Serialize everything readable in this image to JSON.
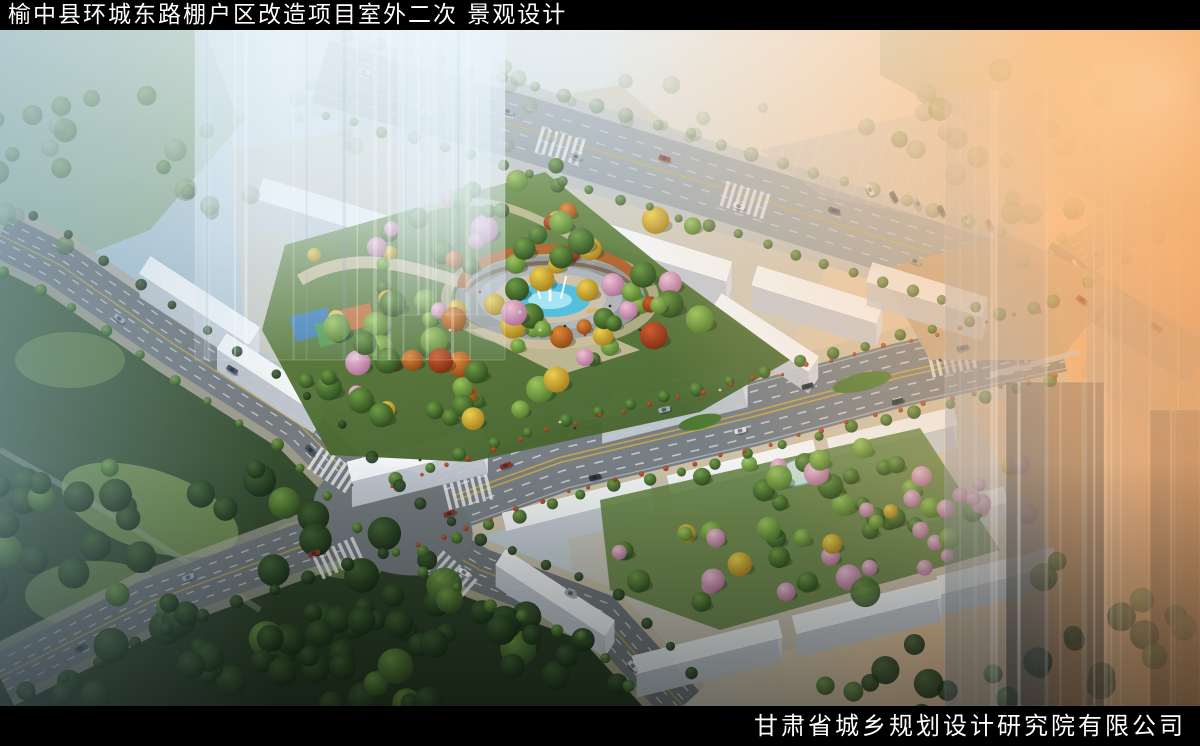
{
  "header": {
    "title": "榆中县环城东路棚户区改造项目室外二次 景观设计"
  },
  "footer": {
    "company": "甘肃省城乡规划设计研究院有限公司"
  },
  "palette": {
    "frame": "#000000",
    "title_text": "#ffffff",
    "haze_blue": "#9fbccd",
    "sun_glow": "#f7a85f",
    "asphalt": "#787f84",
    "lane_yellow": "#d9b23c",
    "sidewalk_tan": "#cdc1a4",
    "building_white": "#f4f7f9",
    "building_shade": "#c3cad2",
    "foliage_green": "#4a7a2e",
    "foliage_dark": "#2f4f28",
    "foliage_autumn": "#e0bc3a",
    "foliage_orange": "#d8802f",
    "foliage_pink": "#e2aec8",
    "fountain_water": "#56bfdb",
    "pergola_rust": "#b2622c",
    "plaza_beige": "#c3a887",
    "park_lawn": "#82a055"
  }
}
